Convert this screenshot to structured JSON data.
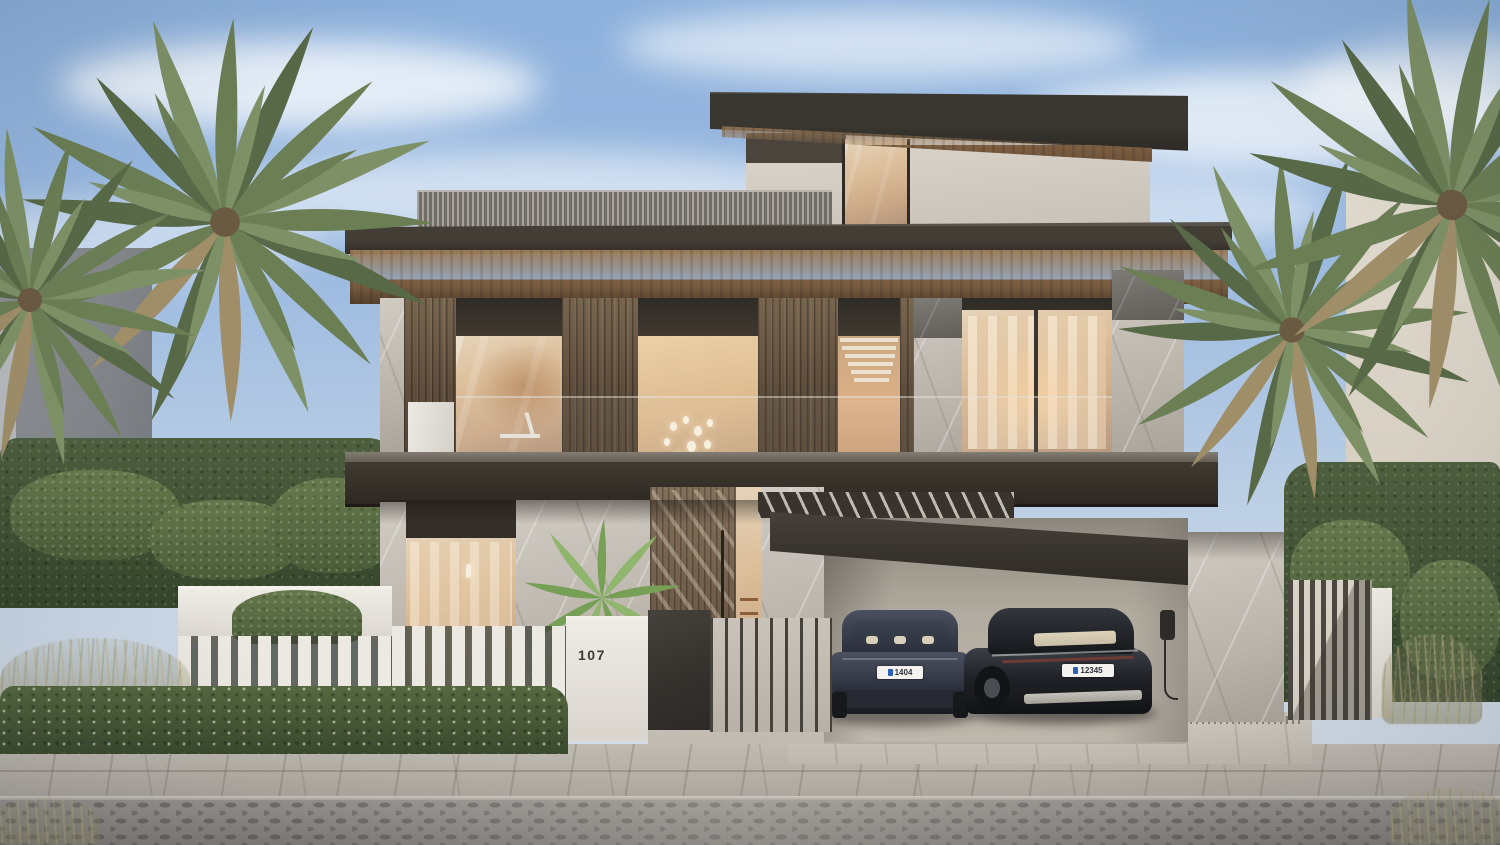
{
  "meta": {
    "title": "Modern villa exterior — dusk architectural rendering",
    "view": "street-front elevation"
  },
  "house": {
    "number": "107",
    "storeys": 3,
    "materials": [
      "stucco",
      "grey marble",
      "timber cladding",
      "full-height glazing"
    ],
    "features": [
      "rooftop louvre screen",
      "cantilevered dark flat roofs",
      "timber soffits",
      "warm-lit interiors",
      "pendant light cluster",
      "staircase window",
      "sheer curtains",
      "timber pivot entry door",
      "double carport"
    ]
  },
  "carport": {
    "cars": [
      {
        "body": "dark blue-grey electric sedan, rear view",
        "plate": "1404"
      },
      {
        "body": "black electric sedan, rear three-quarter view",
        "plate": "12345"
      }
    ],
    "ev_charger": "wall-mounted charger with cable"
  },
  "landscape": {
    "palms": 4,
    "front_palm_shrub": 1,
    "hedges": "tall boundary hedges and trimmed street hedge with white blossoms",
    "grasses": "sandy ornamental grasses",
    "fence": "white marble wall with vertical slats, dark entry gate, thin metal railing, slatted side gate"
  },
  "street": {
    "sidewalk": "light stone pavers",
    "road": "grey cobblestone"
  },
  "palette": {
    "sky_top": "#8db1dc",
    "sky_low": "#d6dde4",
    "roof_dark": "#36322c",
    "timber_soffit": "#8a6a4b",
    "timber_panel": "#685642",
    "stucco": "#d5cfc6",
    "marble": "#c2bcb3",
    "glass_glow": "#e0c29c",
    "curtain": "#f0ddc2",
    "hedge_green": "#46583a",
    "palm_green": "#6b7e54",
    "dry_frond": "#9f8e68",
    "fence_white": "#ece9e2",
    "gate_dark": "#3a3733",
    "sidewalk": "#b5b0a7",
    "road": "#8c8985",
    "car_left": "#39404e",
    "car_right": "#1c1e23",
    "plate_badge": "#2b5fb8"
  }
}
